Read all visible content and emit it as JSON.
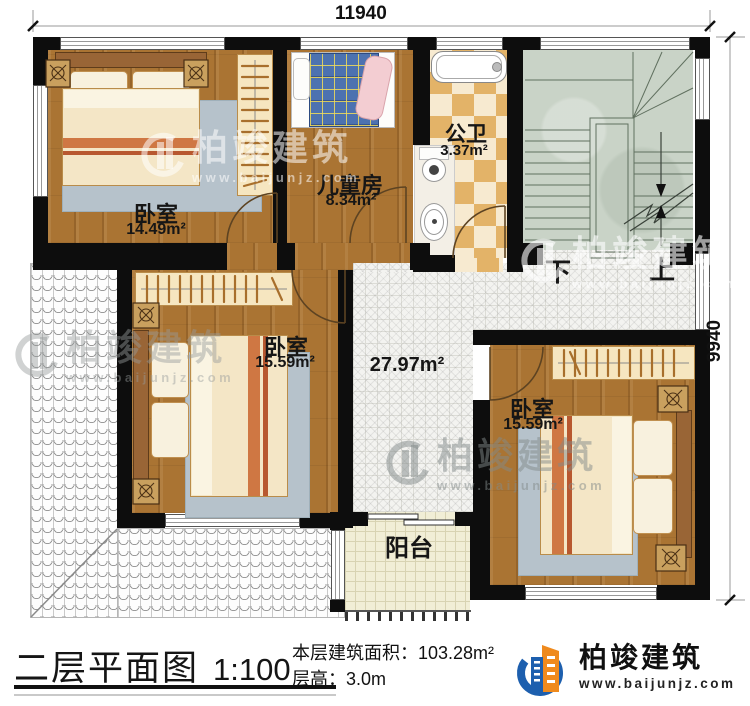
{
  "dimensions": {
    "top": "11940",
    "right": "9940"
  },
  "rooms": {
    "bedroom1": {
      "name": "卧室",
      "area": "14.49m²"
    },
    "kids": {
      "name": "儿童房",
      "area": "8.34m²"
    },
    "bath": {
      "name": "公卫",
      "area": "3.37m²"
    },
    "bedroom2": {
      "name": "卧室",
      "area": "15.59m²"
    },
    "hall": {
      "area": "27.97m²"
    },
    "bedroom3": {
      "name": "卧室",
      "area": "15.59m²"
    },
    "balcony": {
      "name": "阳台"
    }
  },
  "stairs": {
    "down": "下",
    "up": "上"
  },
  "watermark": {
    "brand": "柏竣建筑",
    "url": "www.baijunjz.com"
  },
  "footer": {
    "title": "二层平面图",
    "scale": "1:100",
    "area_label": "本层建筑面积：",
    "area_value": "103.28m²",
    "height_label": "层高：",
    "height_value": "3.0m",
    "brand": "柏竣建筑",
    "brand_url": "www.baijunjz.com",
    "brand_color": "#1d5fae",
    "brand_accent": "#ef8a1d"
  }
}
